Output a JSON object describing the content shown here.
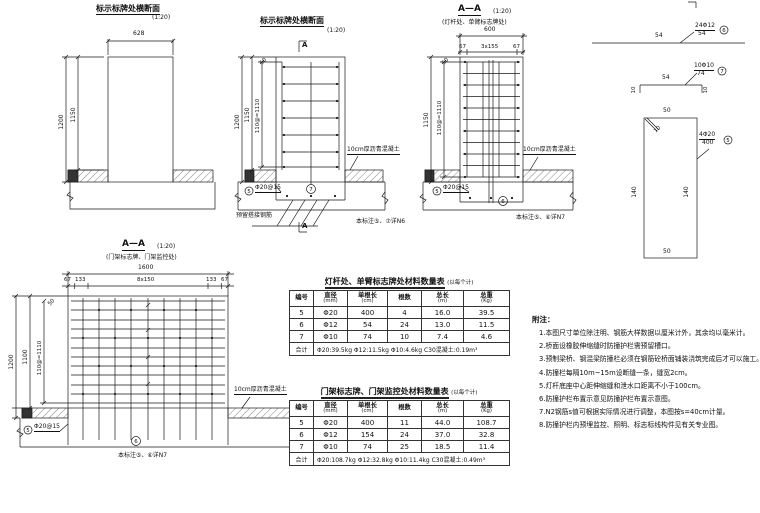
{
  "palette": {
    "line": "#1a1a1a",
    "background": "#ffffff"
  },
  "drawings": {
    "d1": {
      "title": "标示标牌处横断面",
      "scale": "(1:20)",
      "dims": {
        "width": "628",
        "h_outer": "1200",
        "h_inner": "1150"
      }
    },
    "d2": {
      "title": "标示标牌处横断面",
      "scale": "(1:20)",
      "section_mark": "A",
      "dims": {
        "h_outer": "1200",
        "h_inner": "1150",
        "h_bars": "110@=1110",
        "top": "50"
      },
      "pavement_label": "10cm厚沥青混凝土",
      "rebar_label": "Φ20@15",
      "bar5": "5",
      "bar7": "7",
      "dowel_label": "预留搭接钢筋",
      "ref_note": "本标注⑤、⑦详N6"
    },
    "d3": {
      "title": "A—A",
      "scale": "(1:20)",
      "subtitle": "(灯杆处、单臂标志牌处)",
      "dims": {
        "width": "600",
        "seg_left": "67",
        "seg_mid": "3x155",
        "seg_right": "67",
        "h_inner": "1150",
        "h_bars": "110@=1110",
        "top": "50"
      },
      "pavement_label": "10cm厚沥青混凝土",
      "rebar_label": "Φ20@15",
      "bar5": "5",
      "bar6": "6",
      "ref_note": "本标注⑤、⑥详N7"
    },
    "d4": {
      "title": "A—A",
      "scale": "(1:20)",
      "subtitle": "(门架标志牌、门架监控处)",
      "dims": {
        "width": "1600",
        "seg1": "67",
        "seg2": "133",
        "seg3": "8x150",
        "seg4": "133",
        "seg5": "67",
        "h_outer": "1200",
        "h_mid": "1100",
        "h_bars": "110@=1110",
        "top": "50"
      },
      "pavement_label": "10cm厚沥青混凝土",
      "rebar_label": "Φ20@15",
      "bar5": "5",
      "bar6": "6",
      "ref_note": "本标注⑤、⑥详N7"
    }
  },
  "details": {
    "n6": {
      "length": "54",
      "callout_top": "24Φ12",
      "callout_bottom": "54",
      "id": "6"
    },
    "n7": {
      "length": "54",
      "hook": "10",
      "callout_top": "10Φ10",
      "callout_bottom": "74",
      "id": "7"
    },
    "n5": {
      "top": "50",
      "left": "140",
      "right": "140",
      "bottom": "50",
      "hook": "10",
      "callout_top": "4Φ20",
      "callout_bottom": "400",
      "id": "5"
    }
  },
  "tables": [
    {
      "title": "灯杆处、单臂标志牌处材料数量表",
      "unit_note": "(以每个计)",
      "headers": [
        {
          "t": "编号",
          "b": ""
        },
        {
          "t": "直径",
          "b": "(mm)"
        },
        {
          "t": "单根长",
          "b": "(cm)"
        },
        {
          "t": "根数",
          "b": ""
        },
        {
          "t": "总长",
          "b": "(m)"
        },
        {
          "t": "总重",
          "b": "(Kg)"
        }
      ],
      "rows": [
        [
          "5",
          "Φ20",
          "400",
          "4",
          "16.0",
          "39.5"
        ],
        [
          "6",
          "Φ12",
          "54",
          "24",
          "13.0",
          "11.5"
        ],
        [
          "7",
          "Φ10",
          "74",
          "10",
          "7.4",
          "4.6"
        ]
      ],
      "footer_label": "合计",
      "footer": "Φ20:39.5kg  Φ12:11.5kg  Φ10:4.6kg   C30混凝土:0.19m³"
    },
    {
      "title": "门架标志牌、门架监控处材料数量表",
      "unit_note": "(以每个计)",
      "headers": [
        {
          "t": "编号",
          "b": ""
        },
        {
          "t": "直径",
          "b": "(mm)"
        },
        {
          "t": "单根长",
          "b": "(cm)"
        },
        {
          "t": "根数",
          "b": ""
        },
        {
          "t": "总长",
          "b": "(m)"
        },
        {
          "t": "总重",
          "b": "(Kg)"
        }
      ],
      "rows": [
        [
          "5",
          "Φ20",
          "400",
          "11",
          "44.0",
          "108.7"
        ],
        [
          "6",
          "Φ12",
          "154",
          "24",
          "37.0",
          "32.8"
        ],
        [
          "7",
          "Φ10",
          "74",
          "25",
          "18.5",
          "11.4"
        ]
      ],
      "footer_label": "合计",
      "footer": "Φ20:108.7kg  Φ12:32.8kg  Φ10:11.4kg   C30混凝土:0.49m³"
    }
  ],
  "notes": {
    "heading": "附注：",
    "items": [
      "1.本图尺寸单位除注明、钢筋大样数据以厘米计外，其余均以毫米计。",
      "2.桥面设橡胶伸缩缝时防撞护栏需预留槽口。",
      "3.预制梁桥、钢混梁防撞栏必须在钢筋砼桥面铺装浇筑完成后才可以施工。",
      "4.防撞栏每隔10m~15m设断缝一条，缝宽2cm。",
      "5.灯杆底座中心距伸缩缝和泄水口距离不小于100cm。",
      "6.防撞护栏布置示意见防撞护栏布置示意图。",
      "7.N2钢筋s值可根据实际情况进行调整，本图按s=40cm计量。",
      "8.防撞护栏内预埋监控、照明、标志标线构件见有关专业图。"
    ]
  }
}
